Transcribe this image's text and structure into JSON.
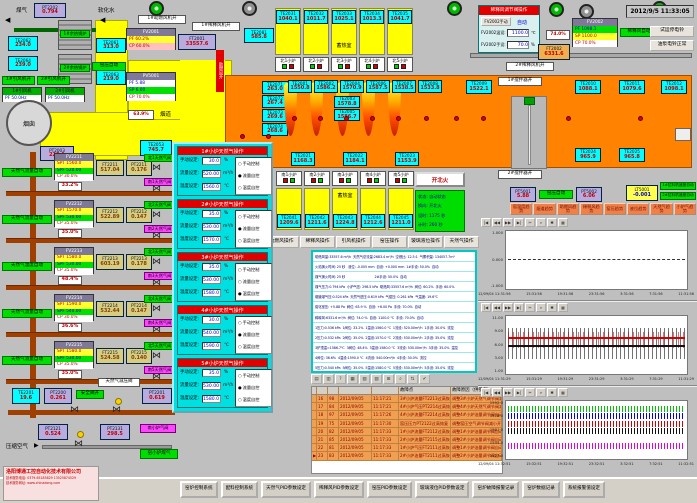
{
  "colors": {
    "furnace_orange": "#ff8200",
    "duct_yellow": "#ffff00",
    "te_cyan": "#00ffff",
    "pt_purple": "#b8acdf",
    "alarm_row_orange": "#f0a050",
    "trend_btn_orange": "#f08048",
    "status_green": "#00dd00",
    "popup_cyan": "#00e0e0",
    "alert_red": "#e00000"
  },
  "window": {
    "datetime": "2012/9/5 11:33:05",
    "run_bell_btn": "试运停电铃",
    "pump_bell_btn": "油泵电铃正常"
  },
  "top_left": {
    "coal_gas": "煤气",
    "soft_water": "软化水",
    "arrow_left": "◀",
    "pt2202": {
      "tag": "PT2202",
      "val": "0.794"
    },
    "boiler1": "1#余热锅炉",
    "boiler2": "2#余热锅炉",
    "te2062": {
      "tag": "TE2062",
      "val": "234.0"
    },
    "te2061": {
      "tag": "TE2061",
      "val": "313.0"
    },
    "te2064": {
      "tag": "TE2064",
      "val": "239.0"
    },
    "te2063": {
      "tag": "TE2063",
      "val": "219.0"
    },
    "idfan1_on": "1#引风机开",
    "idfan2_on": "2#引风机开",
    "idfan1": {
      "title": "1#引风机",
      "row": "PF 50.0Hz"
    },
    "idfan2": {
      "title": "2#引风机",
      "row": "PF 50.0Hz"
    },
    "chimney": "烟囱",
    "kiln_pressure_auto": "窑压自动",
    "pv5001": {
      "title": "PV5001",
      "pf": "PF   5.88",
      "sp": "SP   6.00",
      "cp": "CP  70.0%"
    },
    "damper_pos": "63.9%",
    "flue": "烟道",
    "te2053": {
      "tag": "TE2053",
      "val": "745.7"
    },
    "pt2003": {
      "tag": "PT2003",
      "val": "220.1"
    },
    "blower1_on": "1#助燃风机开",
    "dilution1_on": "1#稀释风机开",
    "fv2001": {
      "title": "FV2001",
      "pf": "PF  60.2%",
      "cp": "CP  60.0%"
    },
    "ft2001": {
      "tag": "FT2001",
      "val": "33557.6"
    },
    "blower_open": "助燃风开",
    "te2081": {
      "tag": "TE2081",
      "val": "585.8"
    }
  },
  "furnace": {
    "regen_label": "蓄热室",
    "north_regen": [
      {
        "tag": "TE2031",
        "val": "1040.1"
      },
      {
        "tag": "TE2032",
        "val": "1011.7"
      },
      {
        "tag": "TE2033",
        "val": "1025.1"
      },
      {
        "tag": "TE2034",
        "val": "1013.3"
      },
      {
        "tag": "TE2035",
        "val": "1041.7"
      }
    ],
    "north_burners": [
      "北1小炉",
      "北2小炉",
      "北3小炉",
      "北4小炉",
      "北5小炉"
    ],
    "left_tes": [
      {
        "tag": "TE2071",
        "val": "263.0"
      },
      {
        "tag": "TE2072",
        "val": "267.4"
      },
      {
        "tag": "TE2073",
        "val": "269.6"
      },
      {
        "tag": "TE2074",
        "val": "268.6"
      }
    ],
    "top_tes": [
      {
        "tag": "TE2001",
        "val": "1550.8"
      },
      {
        "tag": "TE2002",
        "val": "1586.2"
      },
      {
        "tag": "TE2004",
        "val": "1570.9"
      },
      {
        "tag": "TE2006",
        "val": "1587.5"
      },
      {
        "tag": "TE2007",
        "val": "1538.5"
      },
      {
        "tag": "TE2008",
        "val": "1533.8"
      }
    ],
    "mid_tes": [
      {
        "tag": "TE2003",
        "val": "1578.8"
      },
      {
        "tag": "TE2005",
        "val": "1586.7"
      }
    ],
    "bottom_tes": [
      {
        "tag": "TE2021",
        "val": "1168.3"
      },
      {
        "tag": "TE2022",
        "val": "1184.1"
      },
      {
        "tag": "TE2023",
        "val": "1153.9"
      }
    ],
    "te2009": {
      "tag": "TE2009",
      "val": "1522.1"
    },
    "te2010": {
      "tag": "TE2010",
      "val": "1088.1"
    },
    "te2011": {
      "tag": "TE2011",
      "val": "1079.6"
    },
    "te2012": {
      "tag": "TE2012",
      "val": "1098.1"
    },
    "te2024": {
      "tag": "TE2024",
      "val": "965.9"
    },
    "te2025": {
      "tag": "TE2025",
      "val": "965.8"
    },
    "stirrer1_on": "1#搅拌器开",
    "stirrer2_on": "2#搅拌器开",
    "south_burners": [
      "南1小炉",
      "南2小炉",
      "南3小炉",
      "南4小炉",
      "南5小炉"
    ],
    "south_regen": [
      {
        "tag": "TE2041",
        "val": "1209.6"
      },
      {
        "tag": "TE2042",
        "val": "1211.6"
      },
      {
        "tag": "TE2043",
        "val": "1224.8"
      },
      {
        "tag": "TE2044",
        "val": "1212.6"
      },
      {
        "tag": "TE2045",
        "val": "1211.0"
      }
    ],
    "fire_btn": "开北火",
    "status_panel": [
      "状态: 自动状态",
      "换向: 开北火",
      "设时: 1175 秒",
      "计时: 260 秒"
    ]
  },
  "dilution_panel": {
    "title": "稀释风调节阀操作",
    "manual_btn": "FV2002手动",
    "mode": "自动",
    "temp_label": "FV2002温设:",
    "temp_val": "1100.0",
    "temp_unit": "℃",
    "hand_label": "FV2002手设:",
    "hand_val": "70.0",
    "hand_unit": "%"
  },
  "dilution": {
    "pos": "74.0%",
    "ft2002": {
      "tag": "FT2002",
      "val": "6331.6"
    },
    "fv2002": {
      "title": "FV2002",
      "pf": "PF 1098.1",
      "sp": "SP 1100.0",
      "cp": "CP  70.0%"
    },
    "auto": "稀释风自动",
    "fan2_on": "2#稀释风机开"
  },
  "ops_buttons": [
    "小炉气操作",
    "助燃风操作",
    "稀释风操作",
    "引风机操作",
    "窑压操作",
    "玻璃液位操作",
    "天然气操作"
  ],
  "popup": {
    "labels": {
      "manual": "手动设定:",
      "flow": "流量设定:",
      "temp": "温度设定:",
      "mu": "%",
      "fu": "m³/h",
      "tu": "℃",
      "r1": "手动控制",
      "r2": "流量自控",
      "r3": "温度自控"
    },
    "panels": [
      {
        "title": "1#小炉天然气操作",
        "manual": "30.0",
        "flow": "520.00",
        "temp": "1560.0",
        "m1": "○",
        "m2": "●",
        "m3": "○"
      },
      {
        "title": "2#小炉天然气操作",
        "manual": "35.0",
        "flow": "530.00",
        "temp": "1570.0",
        "m1": "○",
        "m2": "●",
        "m3": "○"
      },
      {
        "title": "3#小炉天然气操作",
        "manual": "35.0",
        "flow": "530.00",
        "temp": "1580.0",
        "m1": "○",
        "m2": "○",
        "m3": "●"
      },
      {
        "title": "4#小炉天然气操作",
        "manual": "30.0",
        "flow": "540.00",
        "temp": "1590.0",
        "m1": "○",
        "m2": "●",
        "m3": "○"
      },
      {
        "title": "5#小炉天然气操作",
        "manual": "35.0",
        "flow": "530.00",
        "temp": "1580.0",
        "m1": "○",
        "m2": "●",
        "m3": "○"
      }
    ]
  },
  "gas_loops": [
    {
      "mode": "天然气流量自动",
      "fv": "FV2211",
      "spt": "SPT 1560.0",
      "spf": "SPF 520.00",
      "cp": "CP  30.0%",
      "ft_tag": "FT2211",
      "ft": "517.04",
      "pt_tag": "PT2211",
      "pt": "0.176",
      "pos": "33.2%",
      "north": "北1天然气阀",
      "south": "南1天然气阀"
    },
    {
      "mode": "天然气流量自动",
      "fv": "FV2212",
      "spt": "SPT 1570.0",
      "spf": "SPF 530.00",
      "cp": "CP  35.0%",
      "ft_tag": "FT2212",
      "ft": "522.89",
      "pt_tag": "PT2212",
      "pt": "0.147",
      "pos": "35.0%",
      "north": "北2天然气阀",
      "south": "南2天然气阀"
    },
    {
      "mode": "天然气温度自动",
      "fv": "FV2213",
      "spt": "SPT 1580.0",
      "spf": "SPF 530.00",
      "cp": "CP  35.0%",
      "ft_tag": "FT2213",
      "ft": "603.19",
      "pt_tag": "PT2213",
      "pt": "0.178",
      "pos": "48.4%",
      "north": "北3天然气阀",
      "south": "南3天然气阀"
    },
    {
      "mode": "天然气流量自动",
      "fv": "FV2214",
      "spt": "SPT 1590.0",
      "spf": "SPF 540.00",
      "cp": "CP  30.0%",
      "ft_tag": "FT2214",
      "ft": "532.44",
      "pt_tag": "PT2214",
      "pt": "0.147",
      "pos": "36.6%",
      "north": "北4天然气阀",
      "south": "南4天然气阀"
    },
    {
      "mode": "天然气流量自动",
      "fv": "FV2215",
      "spt": "SPT 1580.0",
      "spf": "SPF 530.00",
      "cp": "CP  35.0%",
      "ft_tag": "FT2215",
      "ft": "524.58",
      "pt_tag": "PT2215",
      "pt": "0.140",
      "pos": "35.0%",
      "north": "北5天然气阀",
      "south": "南5天然气阀"
    }
  ],
  "gas_station": {
    "te2201": {
      "tag": "TE2201",
      "val": "19.6"
    },
    "pt2200": {
      "tag": "PT2200",
      "val": "0.261"
    },
    "safety": "安全阀开",
    "reducer": "天然气减压阀",
    "pt2201": {
      "tag": "PT2201",
      "val": "0.619"
    },
    "compressed_air": "压缩空气",
    "arrow_right": "▶",
    "pt2121": {
      "tag": "PT2121",
      "val": "0.524"
    },
    "pt2131": {
      "tag": "PT2131",
      "val": "298.5"
    },
    "south_small": "南小炉气阀",
    "kiln_gas": "窑小炉煤气"
  },
  "data_panel": {
    "rows": [
      "助燃风量:33557.6 m³/h  天然气总流量:2683.4 m³/h  空燃比: 12.5:1  气累积量: 134057.7m³",
      "火焰换火时间: 25 秒   液位: -0.005 mm  自设: +0.000 mm  1#手设: 50.0%  自动",
      "煤气换火时间: 25 秒                              2#手设: 50.0%  自动",
      "煤气压力:0.794 kPa  小炉气压: 298.5 kPa  助燃风:33557.6 m³/h  阀位: 60.2%  手设: 60.0%",
      "烟道煤气压:0.524 kPa  天然气进压:0.619 kPa  气窑压: 0.261 kPa  气温度: 19.6℃",
      "熔化室压: +5.88 Pa  阀位: 63.9 %  自设: +6.00 Pa  手设: 70.0%  自动",
      "稀释风:6331.6 m³/h  阀位: 74.0 %  自设: 1100.0 ℃  手设: 70.0%  自动",
      "1压力:0.536 kPa  1阀位: 33.2%  1温设:1560.0 ℃  1流设: 520.00m³/h  1手设: 30.0%  流控",
      "2压力:0.532 kPa  2阀位: 35.0%  2温设:1570.0 ℃  2流设: 530.00m³/h  2手设: 35.0%  流控",
      "3炉顶温=1586.7℃  3阀位: 48.4%  3温设:1580.0 ℃  3流设: 530.00m³/h  3手设: 35.0%  温控",
      "4阀位: 36.6%  4温设:1590.0 ℃  4流设: 540.00m³/h  4手设: 30.0%  流控",
      "5压力:0.540 kPa  5阀位: 35.0%  5温设:1580.0 ℃  5流设: 530.00m³/h  5手设: 35.0%  流控"
    ]
  },
  "alarm": {
    "toolbar": [
      "▤",
      "▥",
      "?",
      "▦",
      "▧",
      "▨",
      "⊞",
      "⌕",
      "⇅",
      "✔"
    ],
    "headers": [
      "",
      "",
      "",
      "",
      "",
      "故障点",
      "故障原因（供参考）"
    ],
    "rows": [
      [
        "",
        "16",
        "98",
        "2012/09/05",
        "11:17:21",
        "3#小炉流量FT2213过高恢复",
        "调整3#小炉天然气调节阀减小阀门"
      ],
      [
        "",
        "17",
        "84",
        "2012/09/05",
        "11:17:21",
        "4#小炉气压PT2214过高恢复",
        "调整4#小炉天然气调节阀减小阀门"
      ],
      [
        "",
        "18",
        "97",
        "2012/09/05",
        "11:17:26",
        "4#小炉流量FT2214过高恢复",
        "调整4#小炉油量调节阀自动调节"
      ],
      [
        "",
        "19",
        "75",
        "2012/09/05",
        "11:17:30",
        "窑压压力PT2122过高恢复",
        "调整窑压空气调节阀减小开度"
      ],
      [
        "",
        "20",
        "82",
        "2012/09/05",
        "11:17:33",
        "1#小炉流量FT2112过高恢复",
        "调整1#小炉油量调节阀自动调节"
      ],
      [
        "",
        "21",
        "85",
        "2012/09/05",
        "11:17:33",
        "2#小炉流量FT2115过高恢复",
        "调整2#小炉油量调节阀自动调节"
      ],
      [
        "",
        "22",
        "81",
        "2012/09/05",
        "11:17:33",
        "1#小炉气压FT2111过高恢复",
        "调整1#小炉油量调节阀自动调节"
      ],
      [
        "▶",
        "23",
        "83",
        "2012/09/05",
        "11:17:33",
        "2#小炉油量FT2111过高恢复",
        "调整2#小炉油量调节阀自动调节"
      ]
    ]
  },
  "right_status": {
    "pt5001": {
      "tag": "PT5001",
      "val": "5.88"
    },
    "kiln_auto": "窑压自动",
    "pt5002": {
      "tag": "PT5002",
      "val": "6.06"
    },
    "lt5001": {
      "tag": "LT5001",
      "val": "-0.001"
    },
    "puller1": "1#拉料机速度自动",
    "puller2": "2#拉料机速度自动"
  },
  "trend_buttons": [
    "窑温度趋势",
    "烟道趋势",
    "助燃风趋势",
    "稀释风趋势",
    "窑压趋势",
    "液位趋势",
    "天然气趋势",
    "小炉气趋势"
  ],
  "charts": {
    "toolbar": [
      "|◀",
      "◀◀",
      "▶▶",
      "▶|",
      "✂",
      "⌕",
      "✱",
      "▦"
    ],
    "c1": {
      "yticks": [
        "1.000",
        "0.000",
        "-1.000"
      ],
      "xticks": [
        "12/09/04 11:31:56",
        "15:31:56",
        "19:31:56",
        "23:31:56",
        "3:31:56",
        "7:31:56",
        "11:31:56"
      ]
    },
    "c2": {
      "yticks": [
        "11.00",
        "9.00",
        "6.00",
        "3.00",
        "1.00"
      ],
      "xticks": [
        "12/09/04 11:31:29",
        "15:31:29",
        "19:31:29",
        "23:31:29",
        "3:31:29",
        "7:31:29",
        "11:31:29"
      ]
    },
    "c3": {
      "yticks": [
        "1592.0",
        "1578.0",
        "1561.0",
        "1544.0",
        "1527.0"
      ],
      "xticks": [
        "12/09/04 11:32:51",
        "15:32:51",
        "19:32:51",
        "23:32:51",
        "3:32:51",
        "7:32:51",
        "11:32:51"
      ]
    }
  },
  "bottom_buttons": [
    "窑炉控制系统",
    "配料控制系统",
    "天然气PID参数设定",
    "稀释风PID参数设定",
    "窑压PID参数设定",
    "玻璃液位PID参数设定",
    "窑炉故障报警记录",
    "窑炉数据记录",
    "系统报警值设定"
  ],
  "company": {
    "name": "洛阳博通工控自动化技术有限公司",
    "phone": "技术服务电话: 0379-65185829  13525874529",
    "web": "技术服务网址: www.chinadong.com"
  }
}
